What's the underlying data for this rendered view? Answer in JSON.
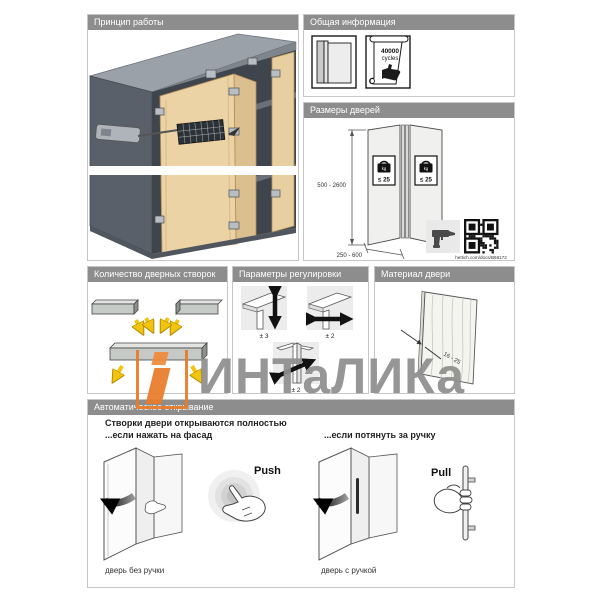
{
  "watermark": {
    "text": "ИНТаЛИКа"
  },
  "panels": {
    "principle": {
      "title": "Принцип работы"
    },
    "general": {
      "title": "Общая информация",
      "scroll_line1": "40000",
      "scroll_line2": "cycles"
    },
    "door_sizes": {
      "title": "Размеры дверей",
      "height_range": "500 - 2600",
      "width_range": "250 - 600",
      "weight_limit": "≤ 25",
      "weight_unit": "kg",
      "link": "hettich.com/docs/B68172"
    },
    "leaf_count": {
      "title": "Количество дверных створок"
    },
    "adjustment": {
      "title": "Параметры регулировки",
      "vertical": "± 3",
      "horizontal": "± 2",
      "depth": "± 2"
    },
    "material": {
      "title": "Материал двери",
      "thickness": "16 - 25"
    },
    "auto_open": {
      "title": "Автоматическое открывание",
      "line1": "Створки двери открываются полностью",
      "line2": "...если нажать на фасад",
      "line3": "...если потянуть за ручку",
      "push_label": "Push",
      "pull_label": "Pull",
      "caption_left": "дверь без ручки",
      "caption_right": "дверь с ручкой"
    }
  },
  "colors": {
    "header_gray": "#8d8d8d",
    "wood": "#ecd3a6",
    "cabinet_dark": "#3f454d",
    "arrow_yellow": "#f2c40e",
    "brand_orange": "#e87b2a",
    "watermark_gray": "#8f8f8f"
  }
}
